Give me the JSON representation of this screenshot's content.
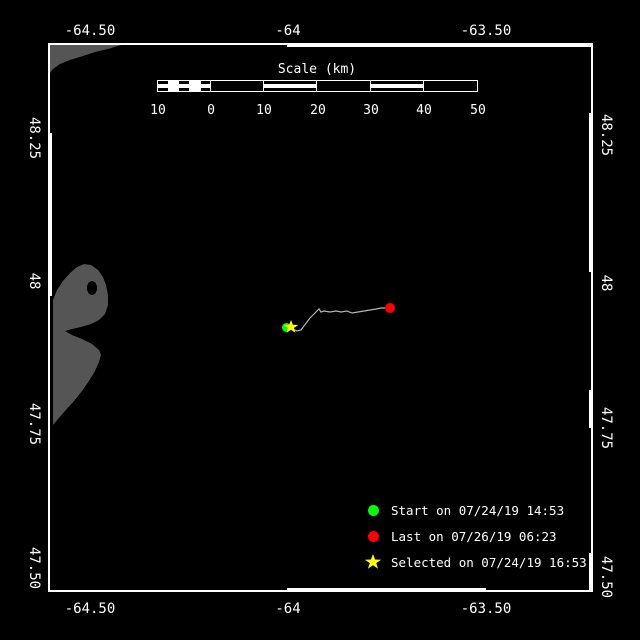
{
  "colors": {
    "background": "#000000",
    "frame": "#ffffff",
    "land": "#555555",
    "track": "#b4b4b4",
    "start": "#00ff00",
    "last": "#ff0000",
    "selected": "#ffff00"
  },
  "axes": {
    "top": [
      "-64.50",
      "-64",
      "-63.50"
    ],
    "bottom": [
      "-64.50",
      "-64",
      "-63.50"
    ],
    "left": [
      "48.25",
      "48",
      "47.75",
      "47.50"
    ],
    "right": [
      "48.25",
      "48",
      "47.75",
      "47.50"
    ]
  },
  "scale_bar": {
    "title": "Scale (km)",
    "ticks": [
      "10",
      "0",
      "10",
      "20",
      "30",
      "40",
      "50"
    ]
  },
  "legend": {
    "items": [
      {
        "marker": "circle",
        "color": "#00ff00",
        "label": "Start on 07/24/19 14:53"
      },
      {
        "marker": "circle",
        "color": "#ff0000",
        "label": "Last on 07/26/19 06:23"
      },
      {
        "marker": "star",
        "color": "#ffff00",
        "label": "Selected on 07/24/19 16:53"
      }
    ]
  },
  "track": {
    "points": [
      [
        288,
        327
      ],
      [
        293,
        329
      ],
      [
        297,
        331
      ],
      [
        301,
        330
      ],
      [
        304,
        326
      ],
      [
        307,
        322
      ],
      [
        310,
        318
      ],
      [
        313,
        315
      ],
      [
        315,
        313
      ],
      [
        317,
        311
      ],
      [
        319,
        309
      ],
      [
        321,
        312
      ],
      [
        324,
        311
      ],
      [
        330,
        312
      ],
      [
        336,
        311
      ],
      [
        341,
        312
      ],
      [
        347,
        311
      ],
      [
        352,
        313
      ],
      [
        358,
        312
      ],
      [
        364,
        311
      ],
      [
        370,
        310
      ],
      [
        376,
        309
      ],
      [
        381,
        308
      ],
      [
        386,
        308
      ],
      [
        390,
        308
      ]
    ],
    "markers": [
      {
        "name": "start",
        "shape": "circle",
        "color": "#00ff00",
        "x": 286,
        "y": 327
      },
      {
        "name": "last",
        "shape": "circle",
        "color": "#ff0000",
        "x": 390,
        "y": 308
      },
      {
        "name": "selected",
        "shape": "star",
        "color": "#ffff00",
        "x": 291,
        "y": 327
      }
    ]
  }
}
